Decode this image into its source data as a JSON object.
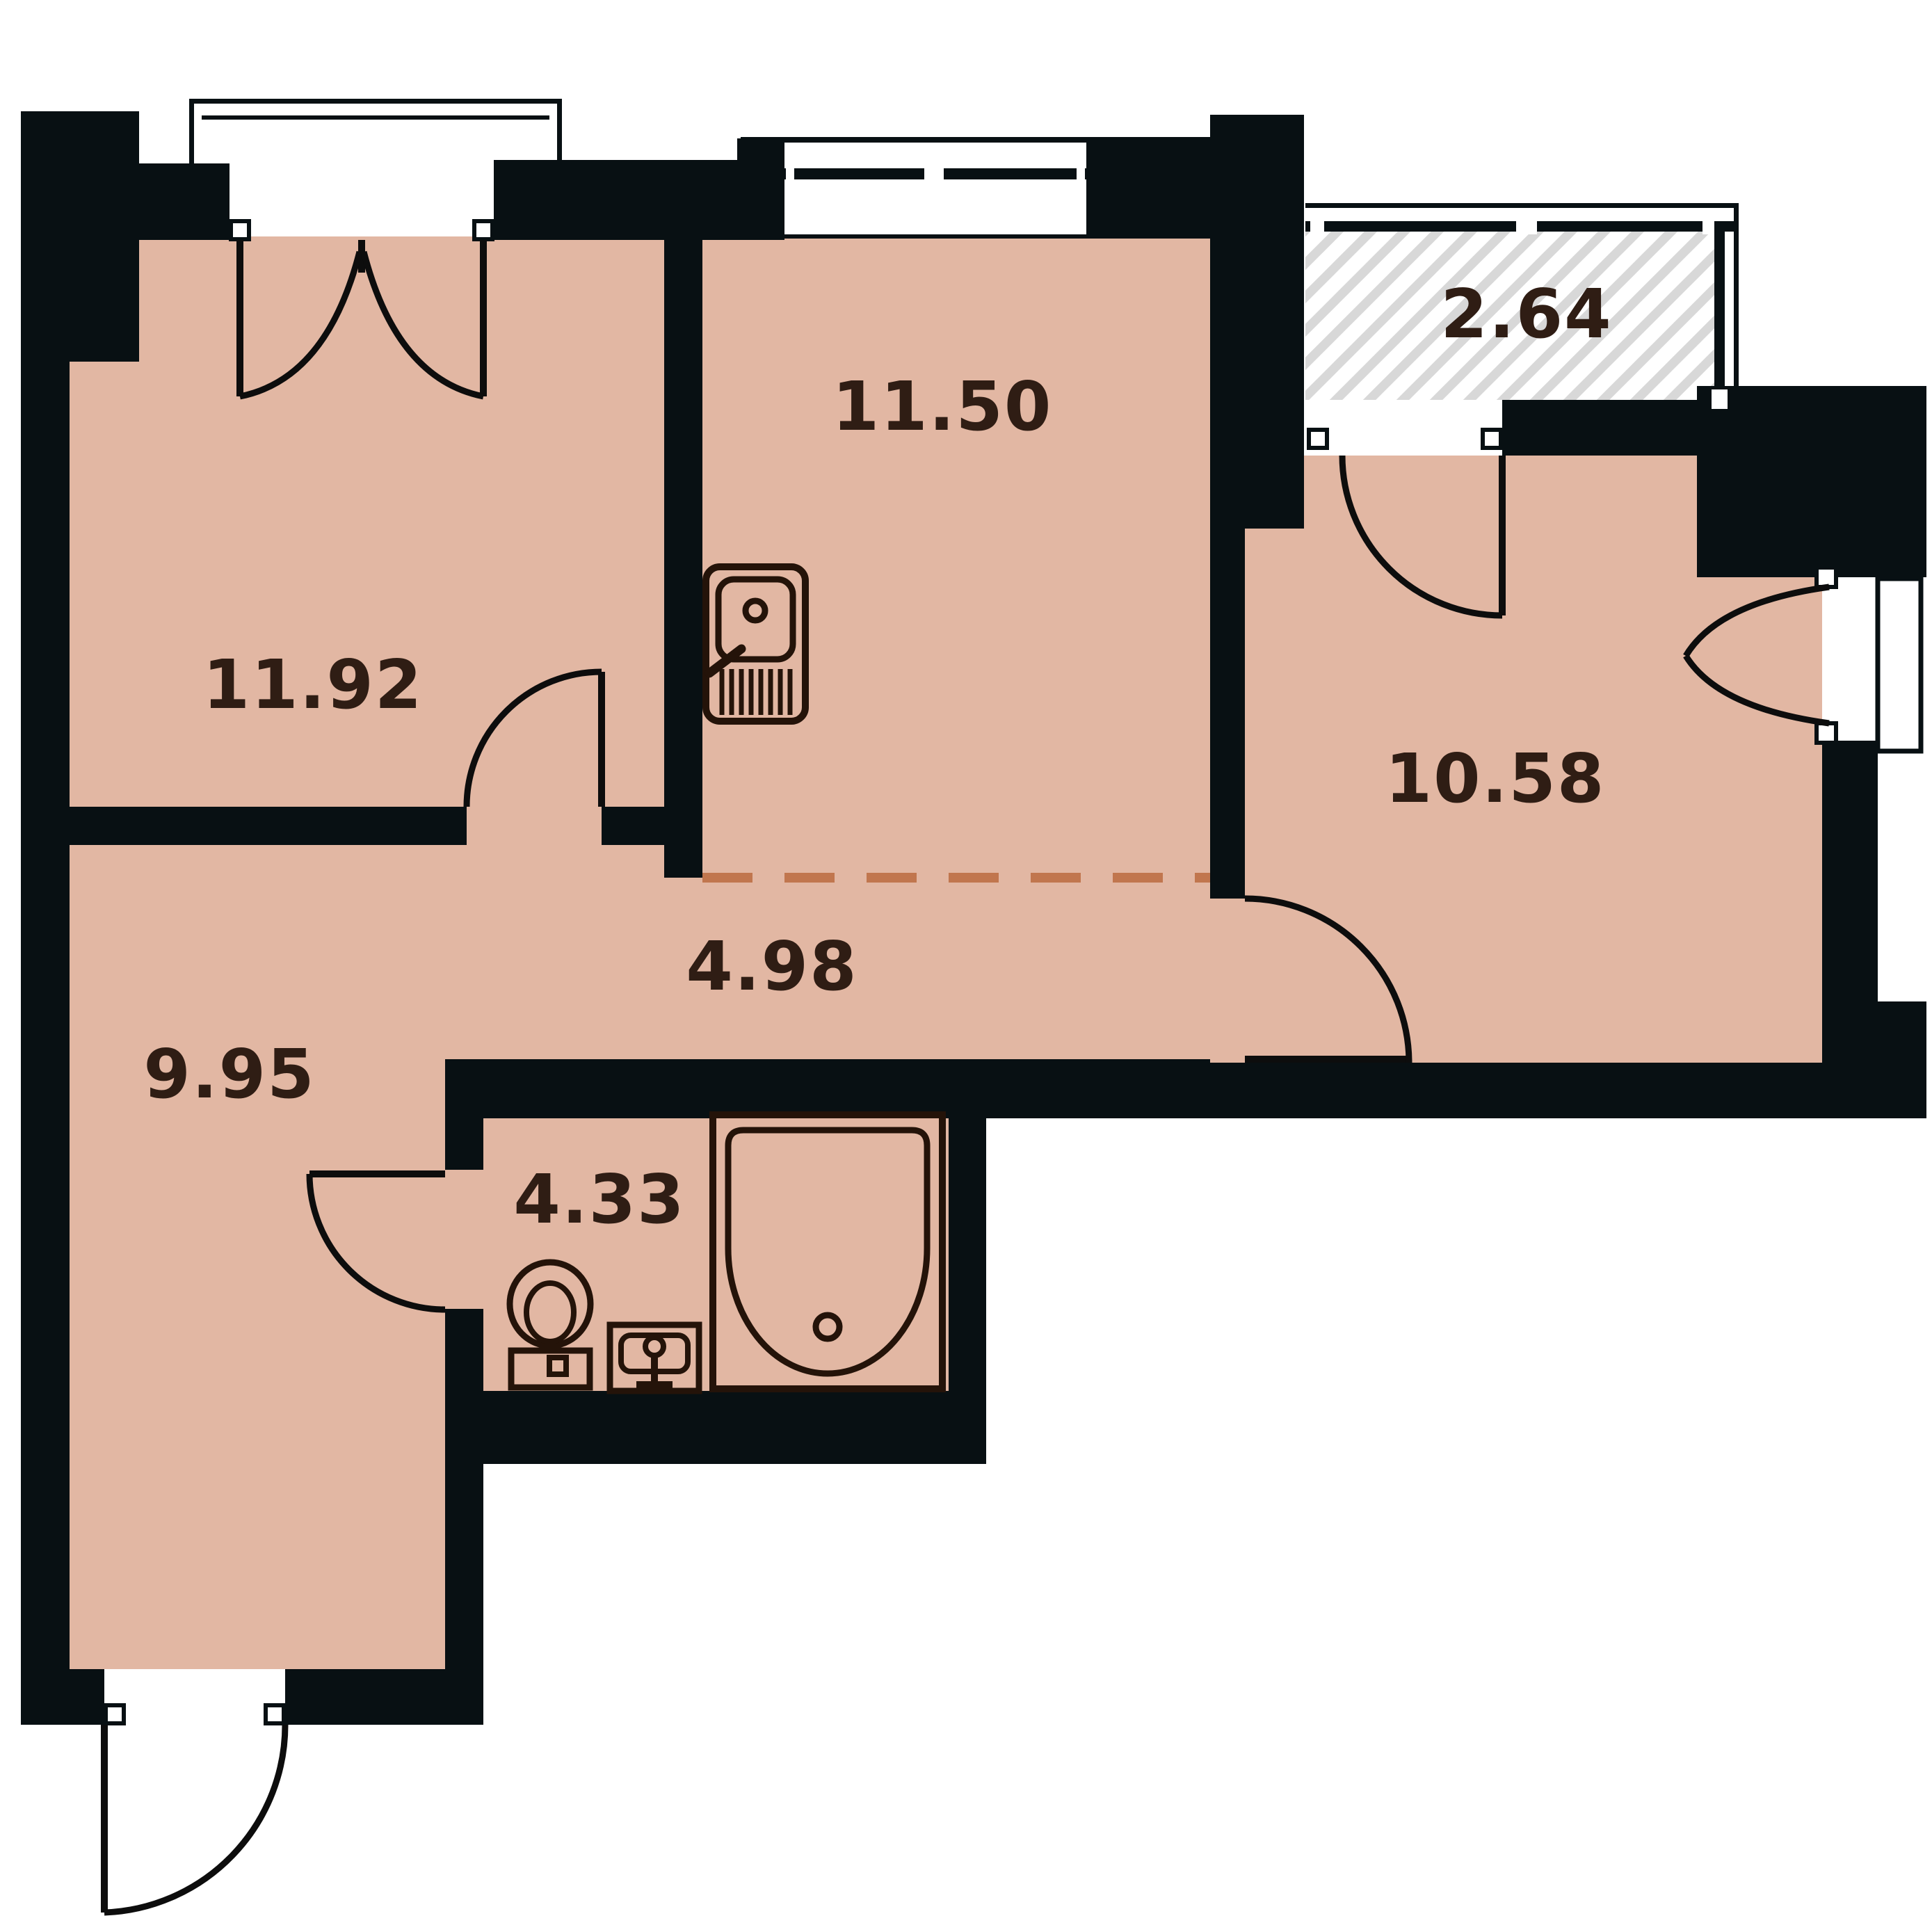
{
  "plan": {
    "type": "apartment-floor-plan",
    "rooms": [
      {
        "id": "room-top-left",
        "area_label": "11.92"
      },
      {
        "id": "kitchen",
        "area_label": "11.50"
      },
      {
        "id": "balcony-hatched",
        "area_label": "2.64"
      },
      {
        "id": "room-right",
        "area_label": "10.58"
      },
      {
        "id": "hallway",
        "area_label": "4.98"
      },
      {
        "id": "room-bottom-left",
        "area_label": "9.95"
      },
      {
        "id": "bathroom",
        "area_label": "4.33"
      }
    ],
    "fixtures": [
      "kitchen-sink-icon",
      "toilet-icon",
      "washbasin-icon",
      "bathtub-icon"
    ],
    "colors": {
      "floor": "#e2b7a3",
      "walls": "#081013",
      "fixture_lines": "#241309",
      "open_boundary_dash": "#c1764e",
      "balcony_hatch": "#d8d8d8",
      "labels": "#2f1d14",
      "background": "#ffffff"
    }
  }
}
